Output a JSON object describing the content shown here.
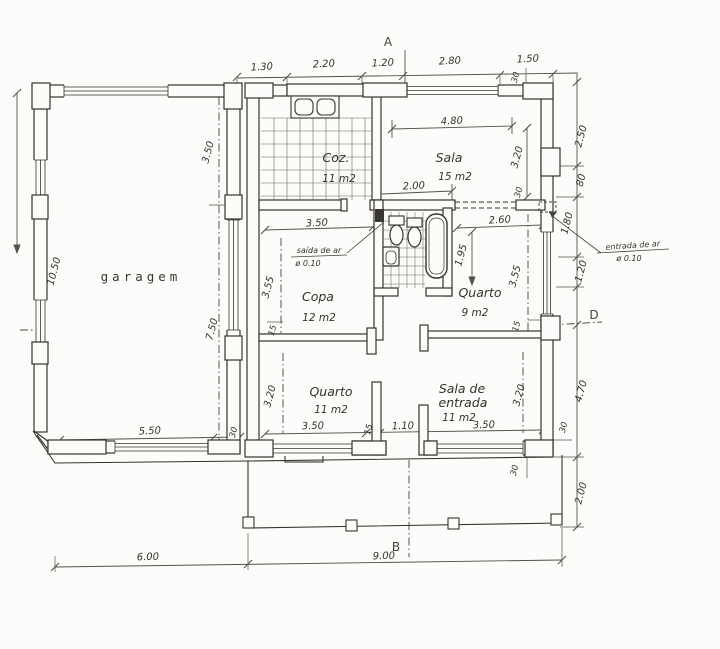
{
  "colors": {
    "ink": "#36332e",
    "dim_line": "#55524b",
    "paper": "#fcfcfa"
  },
  "markers": {
    "a": "A",
    "b": "B",
    "d": "D"
  },
  "rooms": {
    "garagem": {
      "name": "garagem"
    },
    "coz": {
      "name": "Coz.",
      "area": "11 m2"
    },
    "sala": {
      "name": "Sala",
      "area": "15 m2"
    },
    "copa": {
      "name": "Copa",
      "area": "12 m2"
    },
    "quarto9": {
      "name": "Quarto",
      "area": "9 m2"
    },
    "quarto11": {
      "name": "Quarto",
      "area": "11 m2"
    },
    "sala_entrada": {
      "name": "Sala de",
      "name2": "entrada",
      "area": "11 m2"
    }
  },
  "annotations": {
    "saida_ar": {
      "line1": "saída de ar",
      "line2": "ø 0.10"
    },
    "entrada_ar": {
      "line1": "entrada de ar",
      "line2": "ø 0.10"
    }
  },
  "dimensions": {
    "top": {
      "d1": "1.30",
      "d2": "2.20",
      "d3": "1.20",
      "d4": "2.80",
      "d5": "1.50",
      "d6": "30"
    },
    "right": {
      "d1": "2.50",
      "d2": "80",
      "d3": "1.80",
      "d4": "1.20",
      "d5": "4.70",
      "d6": "30",
      "d7": "2.00"
    },
    "bottom": {
      "d1": "6.00",
      "d2": "9.00"
    },
    "left": {
      "d1": "10.50"
    },
    "garage": {
      "d1": "3.50",
      "d2": "7.50",
      "d3": "5.50",
      "d4": "30"
    },
    "sala": {
      "d1": "4.80",
      "d2": "2.00",
      "d3": "3.20",
      "d4": "30"
    },
    "copa": {
      "d1": "3.50",
      "d2": "3.55",
      "d3": "15"
    },
    "quarto9": {
      "d1": "2.60",
      "d2": "1.95",
      "d3": "3.55",
      "d4": "15"
    },
    "quarto11": {
      "d1": "3.20",
      "d2": "3.50",
      "d3": "15",
      "d4": "1.10"
    },
    "sala_entrada": {
      "d1": "3.50",
      "d2": "3.20"
    },
    "misc": {
      "d1": "30"
    }
  }
}
